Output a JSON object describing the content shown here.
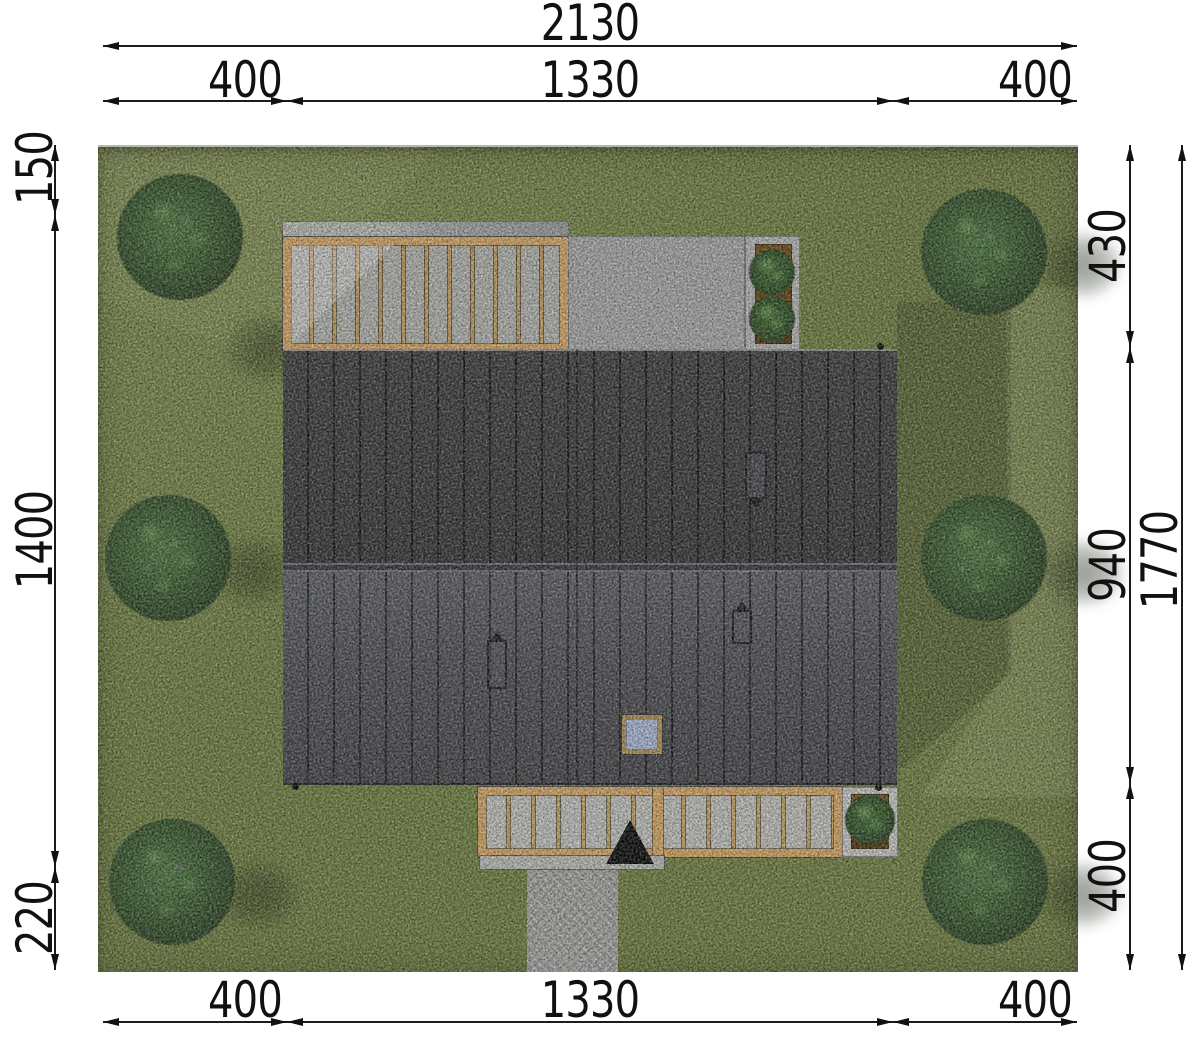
{
  "drawing": {
    "kind_label": "",
    "dimensions": {
      "top": {
        "overall": "2130",
        "segments": [
          "400",
          "1330",
          "400"
        ]
      },
      "bottom": {
        "segments": [
          "400",
          "1330",
          "400"
        ]
      },
      "left": {
        "segments": [
          "150",
          "1400",
          "220"
        ]
      },
      "right": {
        "segments": [
          "430",
          "940",
          "400"
        ],
        "overall": "1770"
      }
    },
    "colors": {
      "grass": "#6e7e40",
      "roof_upper": "#38393d",
      "roof_lower": "#4f5058",
      "wood_frame": "#d8a766",
      "deck_plank": "#b3b4b0",
      "patio": "#a8a8aa",
      "planter_soil": "#5e3c12",
      "tree_canopy": "#33512b",
      "skylight_glass": "#abb8da",
      "entrance_marker": "#060606",
      "dimension_ink": "#111111"
    },
    "counts": {
      "trees": 6,
      "planter_bushes": 3,
      "roof_vents": 3,
      "skylights": 1
    }
  }
}
